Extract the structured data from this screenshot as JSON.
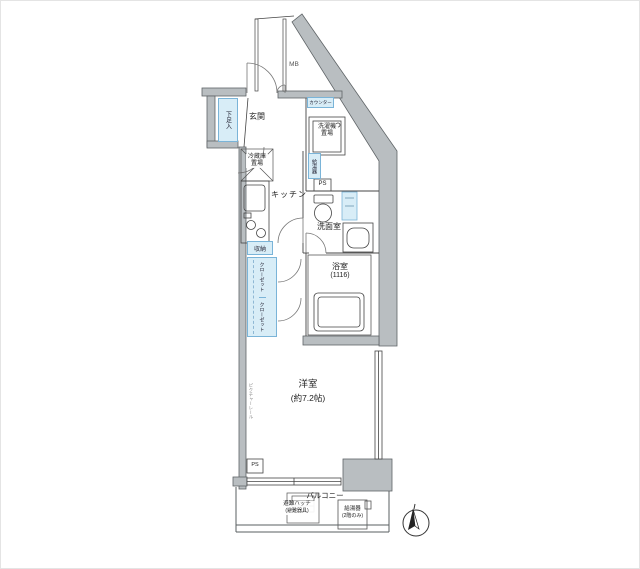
{
  "floorplan": {
    "rooms": {
      "genkan": {
        "label": "玄関"
      },
      "kitchen": {
        "label": "キッチン"
      },
      "washroom": {
        "label": "洗面室"
      },
      "bathroom": {
        "label": "浴室",
        "size": "(1116)"
      },
      "western_room": {
        "label": "洋室",
        "size": "(約7.2帖)"
      },
      "balcony": {
        "label": "バルコニー"
      }
    },
    "fixtures": {
      "meter_box": "MB",
      "shoe_cabinet": "下足入",
      "counter": "カウンター",
      "refrigerator_space": "冷蔵庫置場",
      "washer_space": "洗濯機置場",
      "water_heater": "給湯器",
      "pipe_space": "PS",
      "storage": "収納",
      "closet_upper": "クローゼット",
      "closet_lower": "クローゼット",
      "picture_rail": "ピクチャーレール",
      "pipe_space_2": "PS",
      "evacuation_hatch": {
        "label": "避難ハッチ",
        "note": "(避難器具)"
      },
      "balcony_water_heater": {
        "label": "給湯器",
        "note": "(2階のみ)"
      }
    },
    "colors": {
      "wall_fill": "#b9bec1",
      "wall_edge": "#5f6467",
      "line": "#444444",
      "fixture_fill": "#d8edf7",
      "fixture_border": "#7ab4d8",
      "background": "#ffffff"
    }
  }
}
